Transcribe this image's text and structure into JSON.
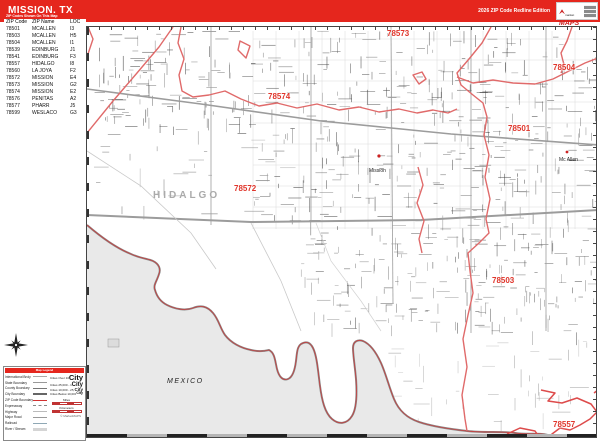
{
  "banner": {
    "title": "MISSION, TX",
    "edition": "2026 ZIP Code Redline Edition",
    "logo": {
      "top": "market",
      "main": "MAPS"
    }
  },
  "zip_table": {
    "header_bar": "ZIP Codes Shown On This Map",
    "columns": {
      "code": "ZIP Code",
      "name": "ZIP Name",
      "loc": "LOC"
    },
    "rows": [
      {
        "code": "78501",
        "name": "MCALLEN",
        "loc": "I3"
      },
      {
        "code": "78503",
        "name": "MCALLEN",
        "loc": "H5"
      },
      {
        "code": "78504",
        "name": "MCALLEN",
        "loc": "I1"
      },
      {
        "code": "78539",
        "name": "EDINBURG",
        "loc": "J1"
      },
      {
        "code": "78541",
        "name": "EDINBURG",
        "loc": "F3"
      },
      {
        "code": "78557",
        "name": "HIDALGO",
        "loc": "I8"
      },
      {
        "code": "78560",
        "name": "LA JOYA",
        "loc": "F2"
      },
      {
        "code": "78572",
        "name": "MISSION",
        "loc": "E4"
      },
      {
        "code": "78573",
        "name": "MISSION",
        "loc": "G2"
      },
      {
        "code": "78574",
        "name": "MISSION",
        "loc": "E2"
      },
      {
        "code": "78576",
        "name": "PENITAS",
        "loc": "A2"
      },
      {
        "code": "78577",
        "name": "PHARR",
        "loc": "J5"
      },
      {
        "code": "78599",
        "name": "WESLACO",
        "loc": "G3"
      }
    ]
  },
  "map": {
    "zip_labels": [
      "78573",
      "78504",
      "78574",
      "78501",
      "78572",
      "78503",
      "78557"
    ],
    "county_label": "HIDALGO",
    "country_label": "MEXICO",
    "city_labels": [
      "Mission",
      "Mc Allen"
    ]
  },
  "legend": {
    "title": "Map Legend",
    "left_items": [
      {
        "label": "International Bndy"
      },
      {
        "label": "State Boundary"
      },
      {
        "label": "County Boundary"
      },
      {
        "label": "City Boundary"
      },
      {
        "label": "ZIP Code Boundary"
      },
      {
        "label": "Expressway"
      },
      {
        "label": "Highway"
      },
      {
        "label": "Major Road"
      },
      {
        "label": "Railroad"
      },
      {
        "label": "River / Stream"
      }
    ],
    "city_items": [
      {
        "label": "Cities Over 100,000",
        "sample": "City"
      },
      {
        "label": "Cities 25,000 - 100,000",
        "sample": "City"
      },
      {
        "label": "Cities 10,000 - 25,000",
        "sample": "City"
      },
      {
        "label": "Cities Below 10,000",
        "sample": "City"
      }
    ],
    "scales": [
      {
        "label": "Miles"
      },
      {
        "label": "Kilometers"
      }
    ],
    "footer": "© MarketMAPS"
  },
  "colors": {
    "brand_red": "#e5261d",
    "zip_boundary_red": "#e06a6a",
    "zip_label_red": "#e0352b",
    "mexico_gray": "#e9e9e9"
  }
}
